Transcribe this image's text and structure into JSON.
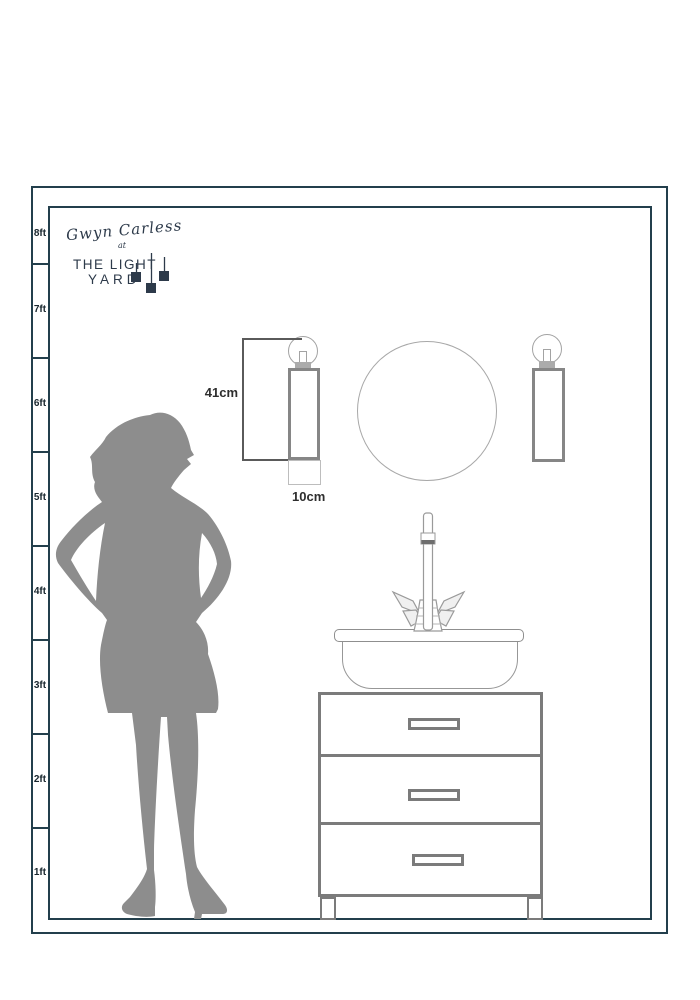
{
  "brand": {
    "script_name": "Gwyn Carless",
    "at_word": "at",
    "title_line1": "THE LIGHT",
    "title_line2": "YARD"
  },
  "ruler": {
    "labels": [
      "8ft",
      "7ft",
      "6ft",
      "5ft",
      "4ft",
      "3ft",
      "2ft",
      "1ft"
    ]
  },
  "annotations": {
    "sconce_height": "41cm",
    "sconce_width": "10cm"
  },
  "colors": {
    "frame_line": "#233f4c",
    "brand_navy": "#2d3a4a",
    "fixture_gray": "#868686",
    "cabinet_gray": "#7b7b7b",
    "silhouette_gray": "#8d8d8d",
    "annotation_text": "#2e2e2e"
  }
}
